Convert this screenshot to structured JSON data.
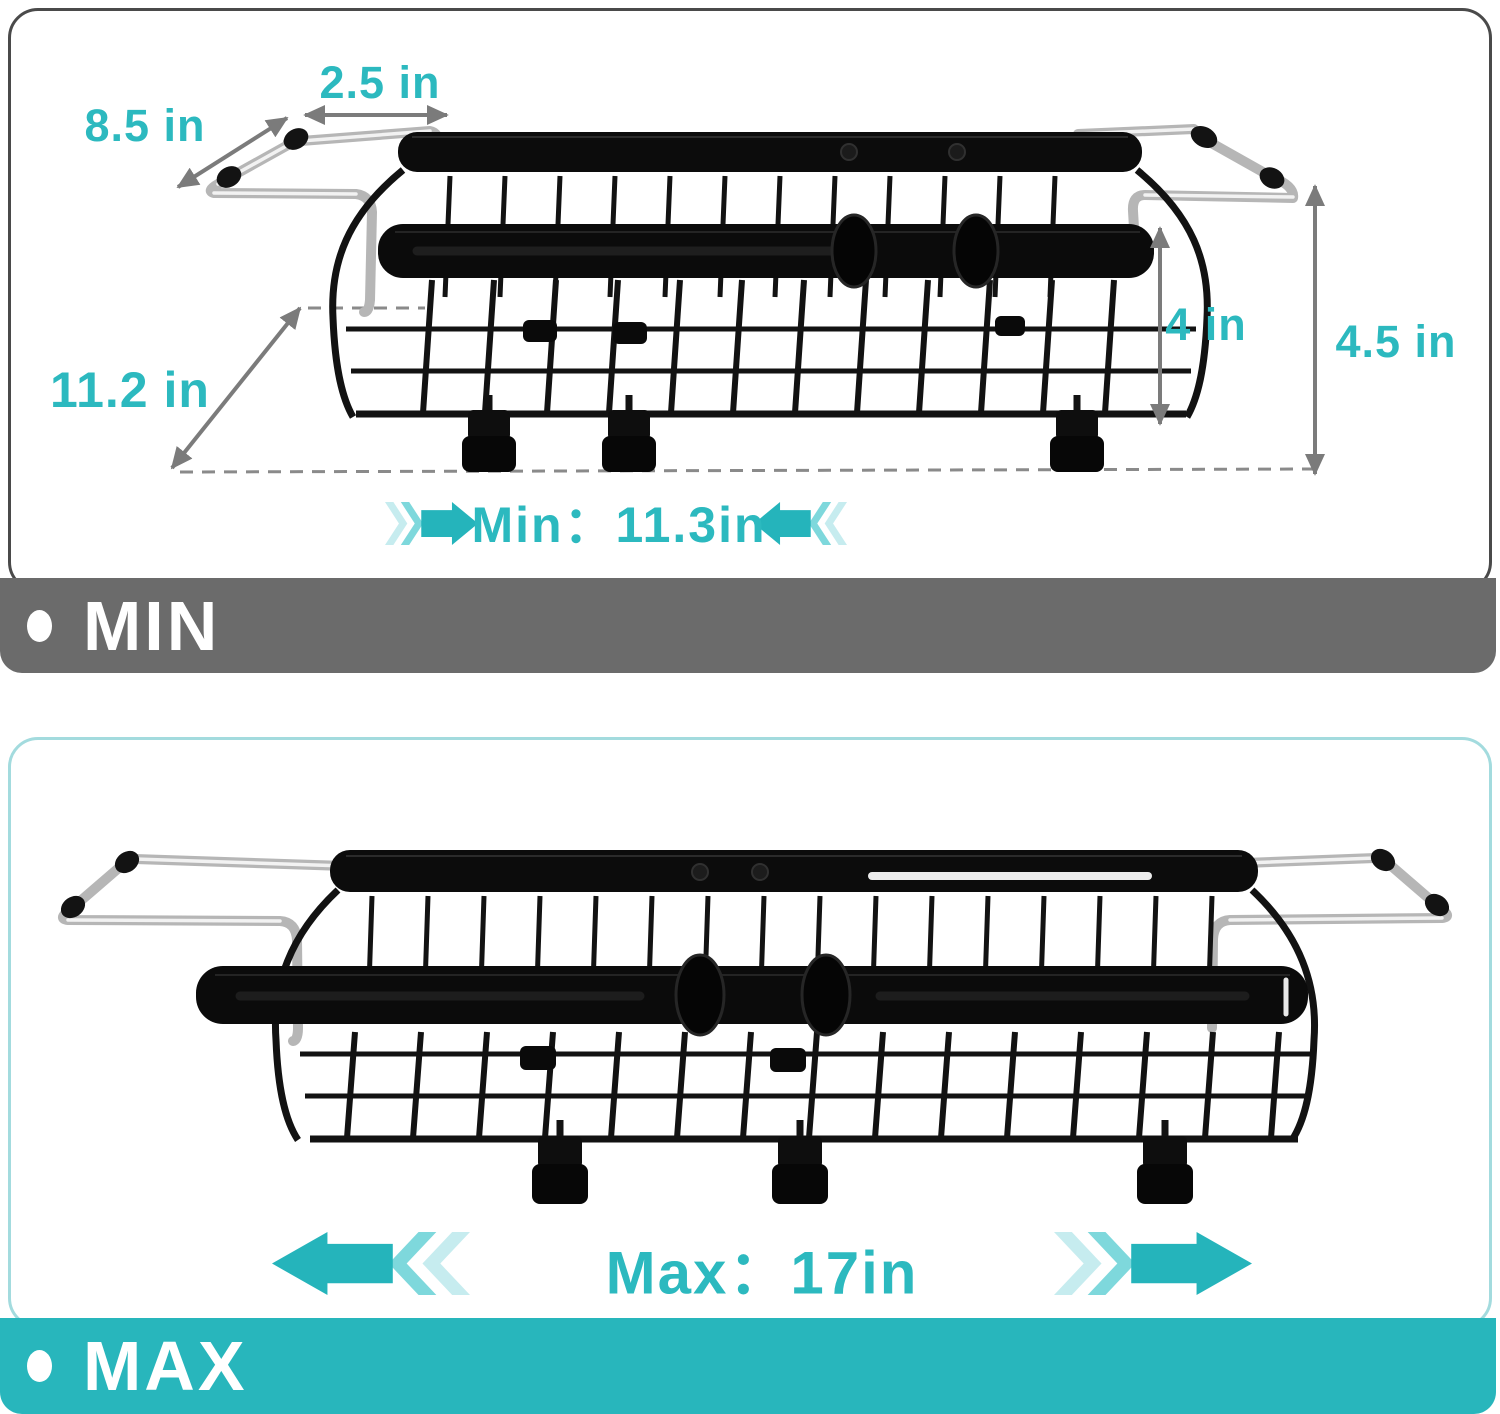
{
  "colors": {
    "accent_teal": "#2CB9BF",
    "arrow_solid": "#25B4BB",
    "arrow_mid": "#7ED8DC",
    "arrow_light": "#C6ECEF",
    "banner_min_bg": "#6B6B6B",
    "banner_max_bg": "#28B6BC",
    "banner_text": "#FFFFFF",
    "card_min_border": "#4A4A4A",
    "card_max_border": "#A3DBDE",
    "dimension_line": "#7B7B7B",
    "rack_black": "#0C0C0C",
    "chrome": "#BDBDBD"
  },
  "sections": {
    "min": {
      "dimensions": {
        "handle_extension": {
          "label": "2.5 in"
        },
        "handle_bar_length": {
          "label": "8.5 in"
        },
        "rack_depth": {
          "label": "11.2 in"
        },
        "basket_height": {
          "label": "4 in"
        },
        "overall_height": {
          "label": "4.5 in"
        }
      },
      "length_callout": {
        "label": "Min：11.3in"
      },
      "banner": {
        "label": "MIN"
      }
    },
    "max": {
      "length_callout": {
        "label": "Max：17in"
      },
      "banner": {
        "label": "MAX"
      }
    }
  }
}
